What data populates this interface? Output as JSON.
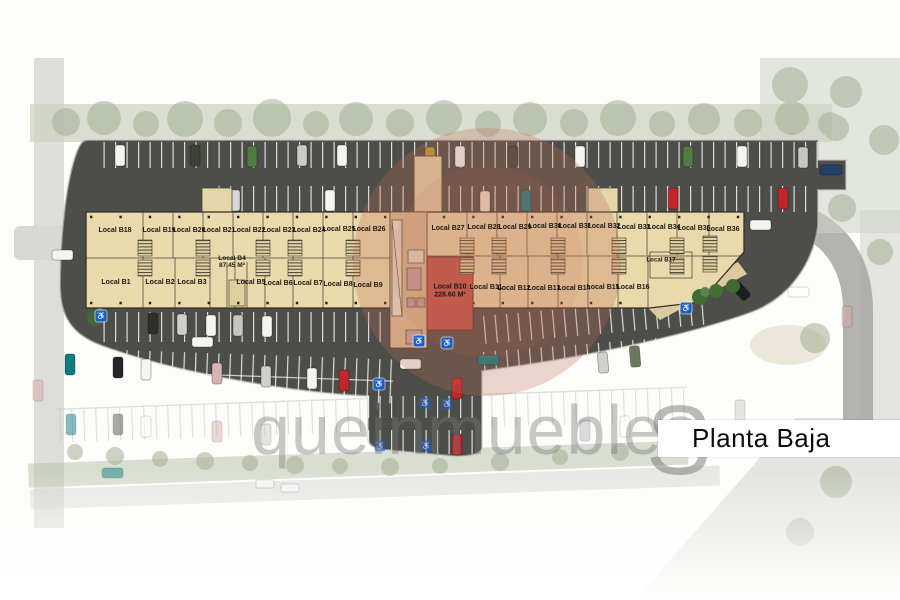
{
  "title": "Planta Baja",
  "watermark": {
    "word": "queinmuebles",
    "letter": "S"
  },
  "icons": {
    "handicap": "♿"
  },
  "locals": {
    "b1": "Local B1",
    "b2": "Local B2",
    "b3": "Local B3",
    "b5": "Local B5",
    "b6": "Local B6",
    "b7": "Local B7",
    "b8": "Local B8",
    "b9": "Local B9",
    "b11": "Local B11",
    "b12": "Local B12",
    "b13": "Local B13",
    "b14": "Local B14",
    "b15": "Local B15",
    "b16": "Local B16",
    "b17": "Local B17",
    "b18": "Local B18",
    "b19": "Local B19",
    "b20": "Local B20",
    "b21": "Local B21",
    "b22": "Local B22",
    "b23": "Local B23",
    "b24": "Local B24",
    "b25": "Local B25",
    "b26": "Local B26",
    "b27": "Local B27",
    "b28": "Local B28",
    "b29": "Local B29",
    "b30": "Local B30",
    "b31": "Local B31",
    "b32": "Local B32",
    "b33": "Local B33",
    "b34": "Local B34",
    "b35": "Local B35",
    "b36": "Local B36"
  },
  "featured": {
    "b4": {
      "label": "Local B4",
      "area": "87.45 M²"
    },
    "b10": {
      "label": "Local B10",
      "area": "228.60 M²"
    }
  }
}
